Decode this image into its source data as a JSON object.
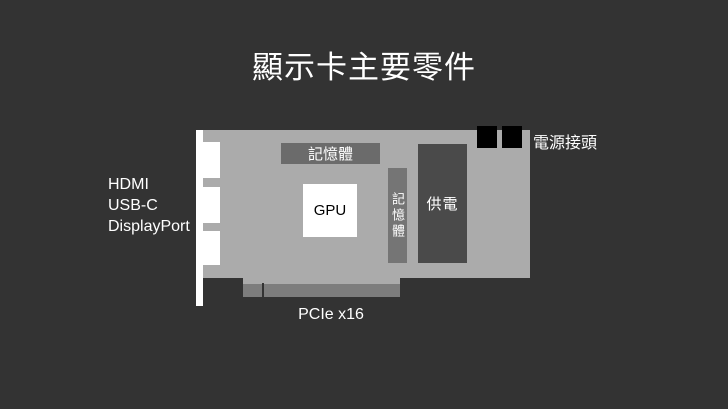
{
  "slide": {
    "title": "顯示卡主要零件"
  },
  "card": {
    "gpu_label": "GPU",
    "memory_top_label": "記憶體",
    "memory_side_label": "記憶體",
    "power_delivery_label": "供電",
    "power_connector_label": "電源接頭",
    "pcie_label": "PCIe x16",
    "port_labels": [
      "HDMI",
      "USB-C",
      "DisplayPort"
    ]
  },
  "colors": {
    "background": "#333333",
    "card_body": "#ababab",
    "bracket": "#ffffff",
    "port_slot": "#ffffff",
    "memory_bar": "#6b6b6b",
    "memory_side_bar": "#757575",
    "power_delivery": "#4a4a4a",
    "power_connector": "#000000",
    "pcie_connector": "#7d7d7d",
    "gpu_chip": "#ffffff",
    "title_text": "#ffffff",
    "gpu_text": "#000000"
  }
}
